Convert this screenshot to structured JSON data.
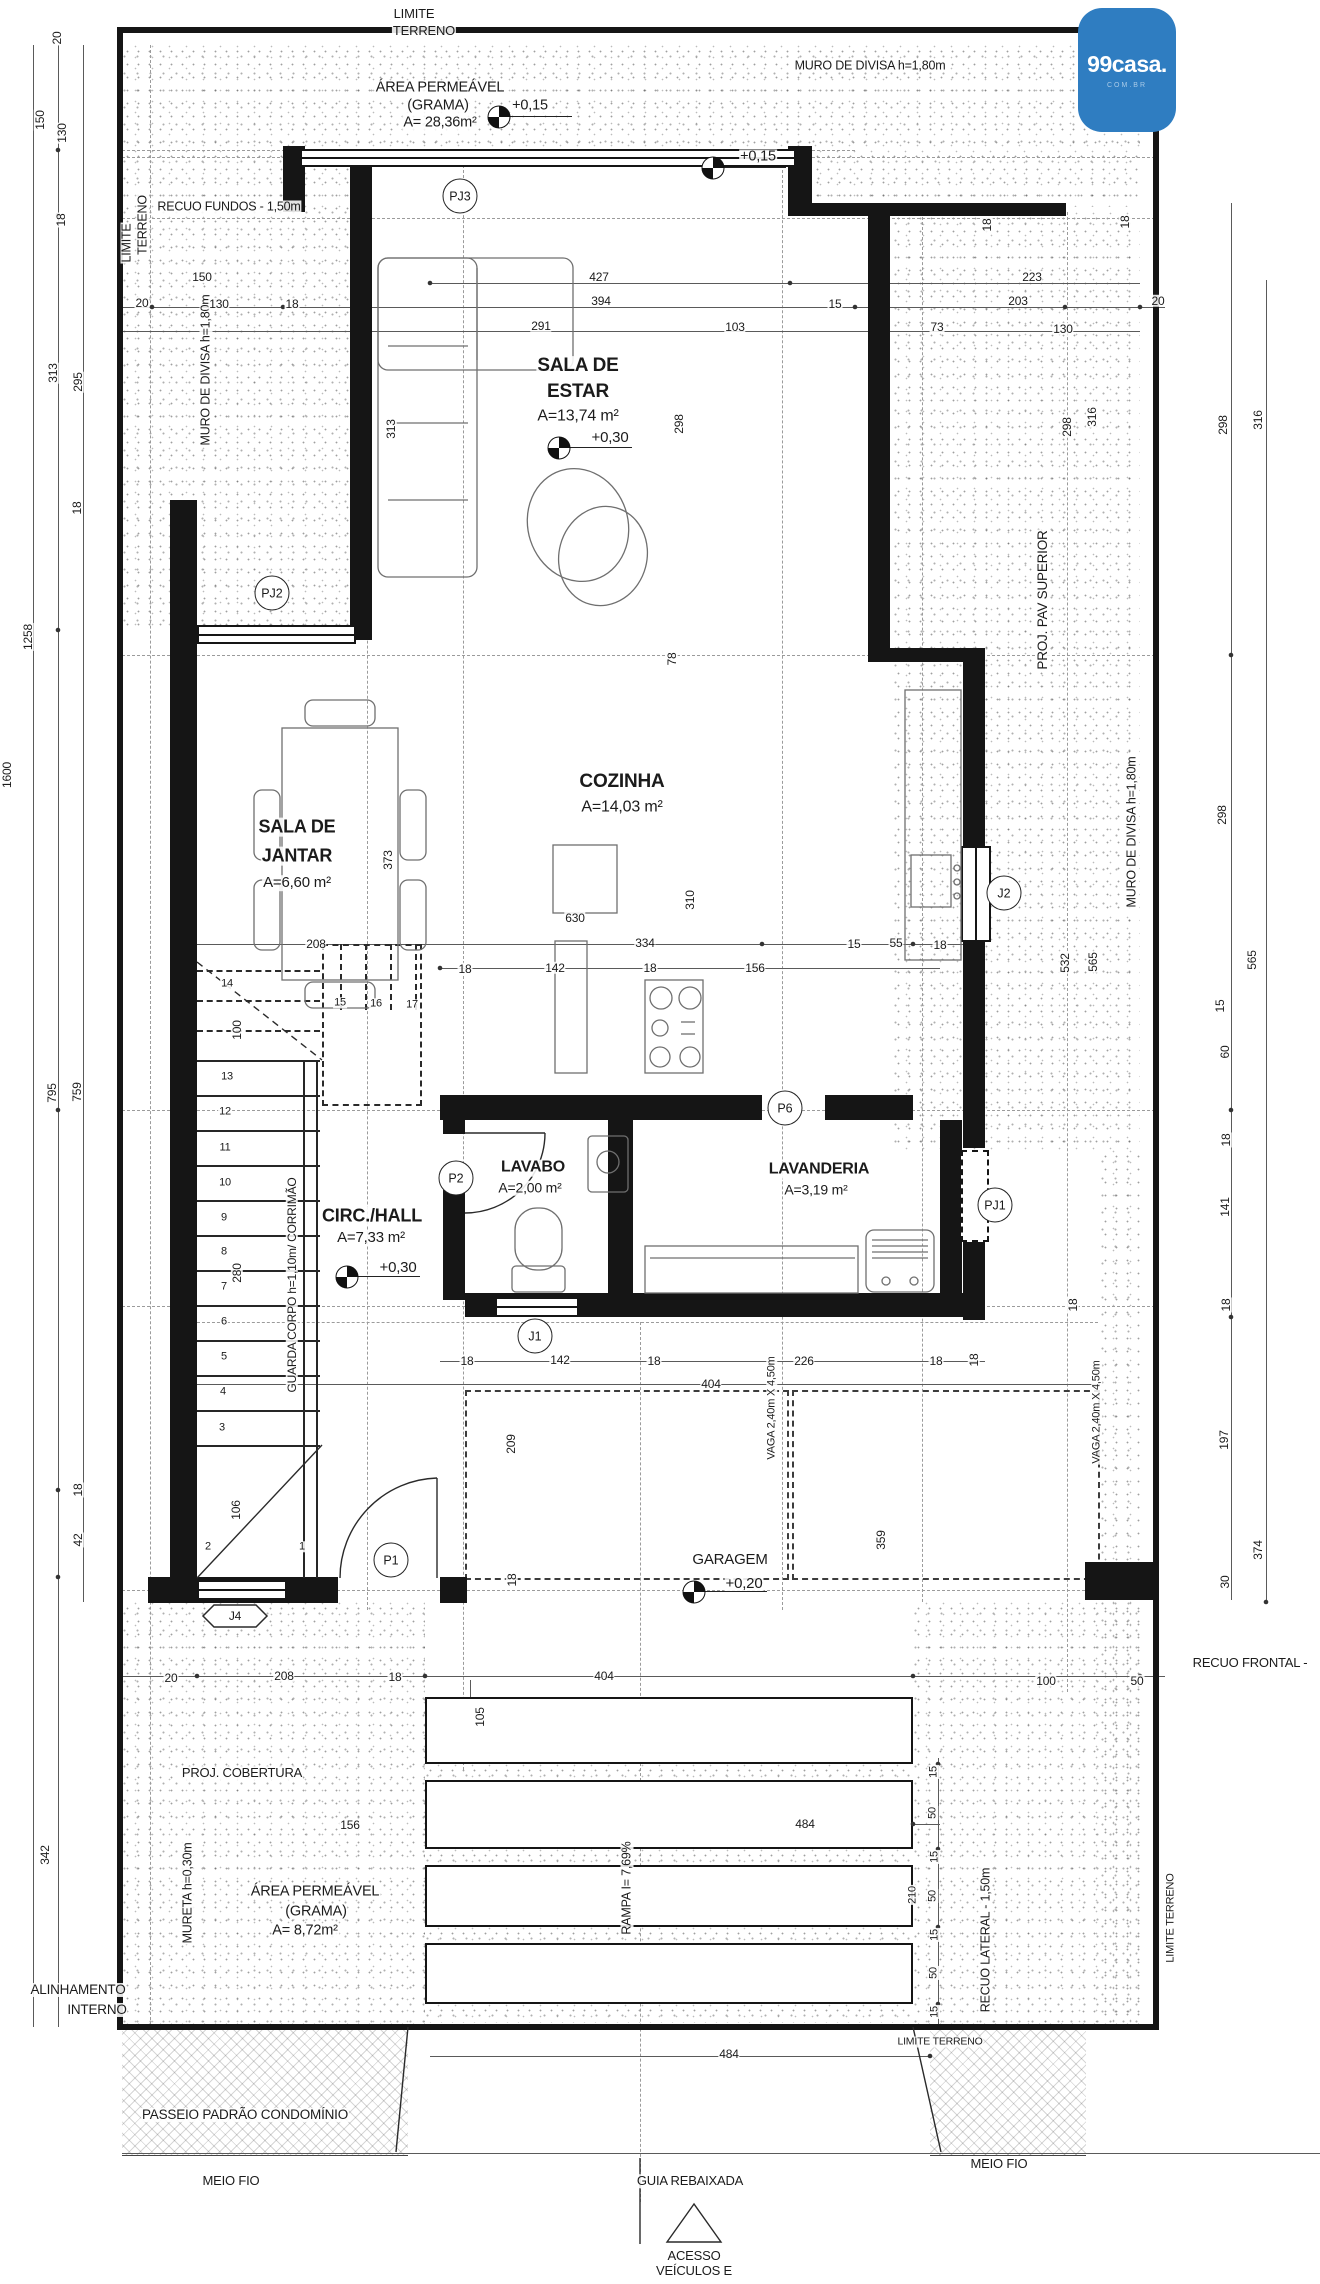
{
  "logo": {
    "brand": "99casa.",
    "tld": "COM.BR"
  },
  "level_markers": [
    {
      "label": "+0,15",
      "x": 499,
      "y": 117
    },
    {
      "label": "+0,15",
      "x": 713,
      "y": 168
    },
    {
      "label": "+0,30",
      "x": 559,
      "y": 448
    },
    {
      "label": "+0,30",
      "x": 347,
      "y": 1277
    },
    {
      "label": "+0,20",
      "x": 694,
      "y": 1592
    }
  ],
  "circle_labels": [
    {
      "t": "PJ3",
      "x": 460,
      "y": 196
    },
    {
      "t": "PJ2",
      "x": 272,
      "y": 593
    },
    {
      "t": "J2",
      "x": 1004,
      "y": 893
    },
    {
      "t": "P2",
      "x": 456,
      "y": 1178
    },
    {
      "t": "P6",
      "x": 785,
      "y": 1108
    },
    {
      "t": "PJ1",
      "x": 995,
      "y": 1205
    },
    {
      "t": "J1",
      "x": 535,
      "y": 1336
    },
    {
      "t": "P1",
      "x": 391,
      "y": 1560
    }
  ],
  "annotations": [
    {
      "n": "limite-terreno-top",
      "t": "LIMITE",
      "x": 414,
      "y": 14,
      "s": 13
    },
    {
      "n": "limite-terreno-top",
      "t": "TERRENO",
      "x": 424,
      "y": 31,
      "s": 13
    },
    {
      "n": "muro-divisa-top",
      "t": "MURO DE DIVISA h=1,80m",
      "x": 870,
      "y": 66,
      "s": 12.5
    },
    {
      "n": "area-permeavel-top",
      "t": "ÁREA PERMEÁVEL",
      "x": 440,
      "y": 88,
      "s": 14.5
    },
    {
      "n": "area-permeavel-top",
      "t": "(GRAMA)",
      "x": 438,
      "y": 106,
      "s": 14.5
    },
    {
      "n": "area-permeavel-top",
      "t": "A= 28,36m²",
      "x": 440,
      "y": 123,
      "s": 14.5
    },
    {
      "n": "level-label",
      "t": "+0,15",
      "x": 530,
      "y": 106,
      "s": 14.5
    },
    {
      "n": "level-label",
      "t": "+0,15",
      "x": 758,
      "y": 157,
      "s": 14.5
    },
    {
      "n": "recuo-fundos",
      "t": "RECUO FUNDOS - 1,50m",
      "x": 229,
      "y": 207,
      "s": 12.5
    },
    {
      "n": "limite-terreno-left",
      "t": "LIMITE",
      "x": 127,
      "y": 243,
      "r": -90,
      "s": 12.5
    },
    {
      "n": "limite-terreno-left",
      "t": "TERRENO",
      "x": 143,
      "y": 225,
      "r": -90,
      "s": 12.5
    },
    {
      "n": "muro-divisa-left",
      "t": "MURO DE DIVISA h=1,80m",
      "x": 206,
      "y": 370,
      "r": -90,
      "s": 12.5
    },
    {
      "n": "proj-pav-superior",
      "t": "PROJ. PAV SUPERIOR",
      "x": 1043,
      "y": 600,
      "r": -90,
      "s": 13.5
    },
    {
      "n": "muro-divisa-right",
      "t": "MURO DE DIVISA h=1,80m",
      "x": 1132,
      "y": 832,
      "r": -90,
      "s": 12.5
    },
    {
      "t": "20",
      "x": 57,
      "y": 38,
      "r": -90
    },
    {
      "t": "150",
      "x": 40,
      "y": 120,
      "r": -90
    },
    {
      "t": "130",
      "x": 62,
      "y": 133,
      "r": -90
    },
    {
      "t": "18",
      "x": 61,
      "y": 220,
      "r": -90
    },
    {
      "t": "150",
      "x": 202,
      "y": 277
    },
    {
      "t": "427",
      "x": 599,
      "y": 277
    },
    {
      "t": "223",
      "x": 1032,
      "y": 277
    },
    {
      "t": "20",
      "x": 142,
      "y": 303
    },
    {
      "t": "130",
      "x": 219,
      "y": 304
    },
    {
      "t": "18",
      "x": 292,
      "y": 304
    },
    {
      "t": "394",
      "x": 601,
      "y": 301
    },
    {
      "t": "15",
      "x": 835,
      "y": 304
    },
    {
      "t": "203",
      "x": 1018,
      "y": 301
    },
    {
      "t": "20",
      "x": 1158,
      "y": 301
    },
    {
      "t": "291",
      "x": 541,
      "y": 326
    },
    {
      "t": "103",
      "x": 735,
      "y": 327
    },
    {
      "t": "73",
      "x": 937,
      "y": 327
    },
    {
      "t": "130",
      "x": 1063,
      "y": 329
    },
    {
      "t": "18",
      "x": 987,
      "y": 225,
      "r": -90
    },
    {
      "t": "18",
      "x": 1125,
      "y": 222,
      "r": -90
    },
    {
      "t": "313",
      "x": 53,
      "y": 373,
      "r": -90
    },
    {
      "t": "295",
      "x": 78,
      "y": 382,
      "r": -90
    },
    {
      "t": "18",
      "x": 77,
      "y": 508,
      "r": -90
    },
    {
      "t": "1258",
      "x": 28,
      "y": 637,
      "r": -90
    },
    {
      "t": "1600",
      "x": 7,
      "y": 775,
      "r": -90
    },
    {
      "t": "795",
      "x": 52,
      "y": 1093,
      "r": -90
    },
    {
      "t": "759",
      "x": 77,
      "y": 1092,
      "r": -90
    },
    {
      "t": "18",
      "x": 78,
      "y": 1490,
      "r": -90
    },
    {
      "t": "42",
      "x": 78,
      "y": 1540,
      "r": -90
    },
    {
      "t": "342",
      "x": 45,
      "y": 1855,
      "r": -90
    },
    {
      "n": "room-sala-estar",
      "t": "SALA DE",
      "x": 578,
      "y": 366,
      "b": 1,
      "s": 19
    },
    {
      "n": "room-sala-estar",
      "t": "ESTAR",
      "x": 578,
      "y": 392,
      "b": 1,
      "s": 19
    },
    {
      "n": "room-sala-estar-area",
      "t": "A=13,74 m²",
      "x": 578,
      "y": 417,
      "s": 16
    },
    {
      "n": "level-label",
      "t": "+0,30",
      "x": 610,
      "y": 438,
      "s": 15
    },
    {
      "t": "313",
      "x": 391,
      "y": 429,
      "r": -90
    },
    {
      "t": "298",
      "x": 679,
      "y": 424,
      "r": -90
    },
    {
      "t": "298",
      "x": 1067,
      "y": 427,
      "r": -90
    },
    {
      "t": "316",
      "x": 1092,
      "y": 417,
      "r": -90
    },
    {
      "t": "298",
      "x": 1223,
      "y": 425,
      "r": -90
    },
    {
      "t": "316",
      "x": 1258,
      "y": 420,
      "r": -90
    },
    {
      "n": "room-sala-jantar",
      "t": "SALA DE",
      "x": 297,
      "y": 827,
      "b": 1,
      "s": 18
    },
    {
      "n": "room-sala-jantar",
      "t": "JANTAR",
      "x": 297,
      "y": 856,
      "b": 1,
      "s": 18
    },
    {
      "n": "room-sala-jantar-area",
      "t": "A=6,60 m²",
      "x": 297,
      "y": 883,
      "s": 15
    },
    {
      "n": "room-cozinha",
      "t": "COZINHA",
      "x": 622,
      "y": 782,
      "b": 1,
      "s": 19
    },
    {
      "n": "room-cozinha-area",
      "t": "A=14,03 m²",
      "x": 622,
      "y": 808,
      "s": 16
    },
    {
      "t": "373",
      "x": 388,
      "y": 860,
      "r": -90
    },
    {
      "t": "78",
      "x": 672,
      "y": 659,
      "r": -90
    },
    {
      "t": "310",
      "x": 690,
      "y": 900,
      "r": -90
    },
    {
      "t": "630",
      "x": 575,
      "y": 918
    },
    {
      "t": "208",
      "x": 316,
      "y": 944
    },
    {
      "t": "334",
      "x": 645,
      "y": 943
    },
    {
      "t": "15",
      "x": 854,
      "y": 944
    },
    {
      "t": "55",
      "x": 896,
      "y": 943
    },
    {
      "t": "18",
      "x": 940,
      "y": 945
    },
    {
      "t": "18",
      "x": 465,
      "y": 969
    },
    {
      "t": "142",
      "x": 555,
      "y": 968
    },
    {
      "t": "18",
      "x": 650,
      "y": 968
    },
    {
      "t": "156",
      "x": 755,
      "y": 968
    },
    {
      "t": "532",
      "x": 1065,
      "y": 963,
      "r": -90
    },
    {
      "t": "565",
      "x": 1093,
      "y": 962,
      "r": -90
    },
    {
      "t": "565",
      "x": 1252,
      "y": 960,
      "r": -90
    },
    {
      "t": "15",
      "x": 1220,
      "y": 1006,
      "r": -90
    },
    {
      "t": "60",
      "x": 1225,
      "y": 1052,
      "r": -90
    },
    {
      "t": "298",
      "x": 1222,
      "y": 815,
      "r": -90
    },
    {
      "t": "18",
      "x": 1226,
      "y": 1140,
      "r": -90
    },
    {
      "t": "141",
      "x": 1225,
      "y": 1207,
      "r": -90
    },
    {
      "t": "18",
      "x": 1226,
      "y": 1305,
      "r": -90
    },
    {
      "t": "197",
      "x": 1224,
      "y": 1440,
      "r": -90
    },
    {
      "t": "374",
      "x": 1258,
      "y": 1550,
      "r": -90
    },
    {
      "t": "30",
      "x": 1225,
      "y": 1582,
      "r": -90
    },
    {
      "n": "room-circ-hall",
      "t": "CIRC./HALL",
      "x": 372,
      "y": 1216,
      "b": 1,
      "s": 18
    },
    {
      "n": "room-circ-hall-area",
      "t": "A=7,33 m²",
      "x": 371,
      "y": 1238,
      "s": 15
    },
    {
      "n": "level-label",
      "t": "+0,30",
      "x": 398,
      "y": 1268,
      "s": 15
    },
    {
      "n": "room-lavabo",
      "t": "LAVABO",
      "x": 533,
      "y": 1168,
      "b": 1,
      "s": 16
    },
    {
      "n": "room-lavabo-area",
      "t": "A=2,00 m²",
      "x": 530,
      "y": 1188,
      "s": 14
    },
    {
      "n": "room-lavanderia",
      "t": "LAVANDERIA",
      "x": 819,
      "y": 1170,
      "b": 1,
      "s": 16
    },
    {
      "n": "room-lavanderia-area",
      "t": "A=3,19 m²",
      "x": 816,
      "y": 1190,
      "s": 14
    },
    {
      "n": "guarda-corpo",
      "t": "GUARDA CORPO h=1,10m/ CORRIMÃO",
      "x": 292,
      "y": 1285,
      "r": -90,
      "s": 12
    },
    {
      "t": "100",
      "x": 237,
      "y": 1030,
      "r": -90
    },
    {
      "t": "280",
      "x": 237,
      "y": 1273,
      "r": -90
    },
    {
      "t": "106",
      "x": 236,
      "y": 1510,
      "r": -90
    },
    {
      "n": "stair-step-label",
      "t": "14",
      "x": 227,
      "y": 984,
      "s": 11
    },
    {
      "n": "stair-step-label",
      "t": "13",
      "x": 227,
      "y": 1077,
      "s": 11
    },
    {
      "n": "stair-step-label",
      "t": "12",
      "x": 225,
      "y": 1112,
      "s": 11
    },
    {
      "n": "stair-step-label",
      "t": "11",
      "x": 225,
      "y": 1148,
      "s": 11
    },
    {
      "n": "stair-step-label",
      "t": "10",
      "x": 225,
      "y": 1183,
      "s": 11
    },
    {
      "n": "stair-step-label",
      "t": "9",
      "x": 224,
      "y": 1218,
      "s": 11
    },
    {
      "n": "stair-step-label",
      "t": "8",
      "x": 224,
      "y": 1252,
      "s": 11
    },
    {
      "n": "stair-step-label",
      "t": "7",
      "x": 224,
      "y": 1287,
      "s": 11
    },
    {
      "n": "stair-step-label",
      "t": "6",
      "x": 224,
      "y": 1322,
      "s": 11
    },
    {
      "n": "stair-step-label",
      "t": "5",
      "x": 224,
      "y": 1357,
      "s": 11
    },
    {
      "n": "stair-step-label",
      "t": "4",
      "x": 223,
      "y": 1392,
      "s": 11
    },
    {
      "n": "stair-step-label",
      "t": "3",
      "x": 222,
      "y": 1428,
      "s": 11
    },
    {
      "n": "stair-step-label",
      "t": "2",
      "x": 208,
      "y": 1547,
      "s": 11
    },
    {
      "n": "stair-step-label",
      "t": "1",
      "x": 302,
      "y": 1547,
      "s": 11
    },
    {
      "n": "stair-step-label",
      "t": "15",
      "x": 340,
      "y": 1003,
      "s": 11
    },
    {
      "n": "stair-step-label",
      "t": "16",
      "x": 376,
      "y": 1004,
      "s": 11
    },
    {
      "n": "stair-step-label",
      "t": "17",
      "x": 412,
      "y": 1005,
      "s": 11
    },
    {
      "t": "18",
      "x": 974,
      "y": 1360,
      "r": -90
    },
    {
      "t": "18",
      "x": 1073,
      "y": 1305,
      "r": -90
    },
    {
      "n": "room-garagem",
      "t": "GARAGEM",
      "x": 730,
      "y": 1560,
      "s": 15
    },
    {
      "n": "level-label",
      "t": "+0,20",
      "x": 744,
      "y": 1584,
      "s": 15
    },
    {
      "n": "vaga-label",
      "t": "VAGA 2,40m X 4,50m",
      "x": 772,
      "y": 1408,
      "r": -90,
      "s": 11
    },
    {
      "n": "vaga-label",
      "t": "VAGA 2,40m X 4,50m",
      "x": 1097,
      "y": 1412,
      "r": -90,
      "s": 11
    },
    {
      "t": "18",
      "x": 467,
      "y": 1361
    },
    {
      "t": "142",
      "x": 560,
      "y": 1360
    },
    {
      "t": "18",
      "x": 654,
      "y": 1361
    },
    {
      "t": "226",
      "x": 804,
      "y": 1361
    },
    {
      "t": "18",
      "x": 936,
      "y": 1361
    },
    {
      "t": "404",
      "x": 711,
      "y": 1384
    },
    {
      "t": "209",
      "x": 511,
      "y": 1444,
      "r": -90
    },
    {
      "t": "359",
      "x": 881,
      "y": 1540,
      "r": -90
    },
    {
      "t": "18",
      "x": 512,
      "y": 1580,
      "r": -90
    },
    {
      "n": "window-tag-j4",
      "t": "J4",
      "x": 235,
      "y": 1616,
      "s": 12
    },
    {
      "t": "20",
      "x": 171,
      "y": 1678
    },
    {
      "t": "208",
      "x": 284,
      "y": 1676
    },
    {
      "t": "18",
      "x": 395,
      "y": 1677
    },
    {
      "t": "404",
      "x": 604,
      "y": 1676
    },
    {
      "t": "100",
      "x": 1046,
      "y": 1681
    },
    {
      "t": "50",
      "x": 1137,
      "y": 1681
    },
    {
      "n": "recuo-frontal",
      "t": "RECUO FRONTAL -",
      "x": 1250,
      "y": 1663,
      "s": 13
    },
    {
      "t": "105",
      "x": 480,
      "y": 1717,
      "r": -90
    },
    {
      "n": "proj-cobertura",
      "t": "PROJ. COBERTURA",
      "x": 242,
      "y": 1773,
      "s": 13
    },
    {
      "t": "156",
      "x": 350,
      "y": 1825
    },
    {
      "t": "484",
      "x": 805,
      "y": 1824
    },
    {
      "n": "mureta",
      "t": "MURETA h=0,30m",
      "x": 188,
      "y": 1893,
      "r": -90,
      "s": 12.5
    },
    {
      "n": "area-permeavel-bottom",
      "t": "ÁREA PERMEÁVEL",
      "x": 315,
      "y": 1892,
      "s": 14.5
    },
    {
      "n": "area-permeavel-bottom",
      "t": "(GRAMA)",
      "x": 316,
      "y": 1912,
      "s": 14.5
    },
    {
      "n": "area-permeavel-bottom",
      "t": "A= 8,72m²",
      "x": 305,
      "y": 1931,
      "s": 14.5
    },
    {
      "n": "rampa",
      "t": "RAMPA I= 7,69%",
      "x": 627,
      "y": 1888,
      "r": -90,
      "s": 12.5
    },
    {
      "t": "15",
      "x": 934,
      "y": 1772,
      "r": -90,
      "s": 11
    },
    {
      "t": "50",
      "x": 933,
      "y": 1813,
      "r": -90,
      "s": 11
    },
    {
      "t": "15",
      "x": 935,
      "y": 1857,
      "r": -90,
      "s": 11
    },
    {
      "t": "50",
      "x": 933,
      "y": 1896,
      "r": -90,
      "s": 11
    },
    {
      "t": "15",
      "x": 935,
      "y": 1935,
      "r": -90,
      "s": 11
    },
    {
      "t": "50",
      "x": 934,
      "y": 1973,
      "r": -90,
      "s": 11
    },
    {
      "t": "15",
      "x": 935,
      "y": 2012,
      "r": -90,
      "s": 11
    },
    {
      "t": "210",
      "x": 913,
      "y": 1895,
      "r": -90,
      "s": 11
    },
    {
      "n": "recuo-lateral",
      "t": "RECUO LATERAL - 1,50m",
      "x": 986,
      "y": 1940,
      "r": -90,
      "s": 12.5
    },
    {
      "n": "limite-terreno-right",
      "t": "LIMITE TERRENO",
      "x": 1171,
      "y": 1918,
      "r": -90,
      "s": 11
    },
    {
      "n": "limite-terreno-bottom",
      "t": "LIMITE TERRENO",
      "x": 940,
      "y": 2042,
      "s": 10.5
    },
    {
      "t": "484",
      "x": 729,
      "y": 2054
    },
    {
      "n": "alinhamento-interno",
      "t": "ALINHAMENTO",
      "x": 78,
      "y": 1990,
      "s": 13.5
    },
    {
      "n": "alinhamento-interno",
      "t": "INTERNO",
      "x": 97,
      "y": 2010,
      "s": 13.5
    },
    {
      "n": "passeio",
      "t": "PASSEIO PADRÃO CONDOMÍNIO",
      "x": 245,
      "y": 2115,
      "s": 13.5
    },
    {
      "n": "meio-fio-left",
      "t": "MEIO FIO",
      "x": 231,
      "y": 2181,
      "s": 13
    },
    {
      "n": "meio-fio-right",
      "t": "MEIO FIO",
      "x": 999,
      "y": 2164,
      "s": 13
    },
    {
      "n": "guia-rebaixada",
      "t": "GUIA REBAIXADA",
      "x": 690,
      "y": 2181,
      "s": 13
    },
    {
      "n": "acesso-veiculos",
      "t": "ACESSO",
      "x": 694,
      "y": 2256,
      "s": 13
    },
    {
      "n": "acesso-veiculos",
      "t": "VEÍCULOS E",
      "x": 694,
      "y": 2271,
      "s": 13
    }
  ]
}
